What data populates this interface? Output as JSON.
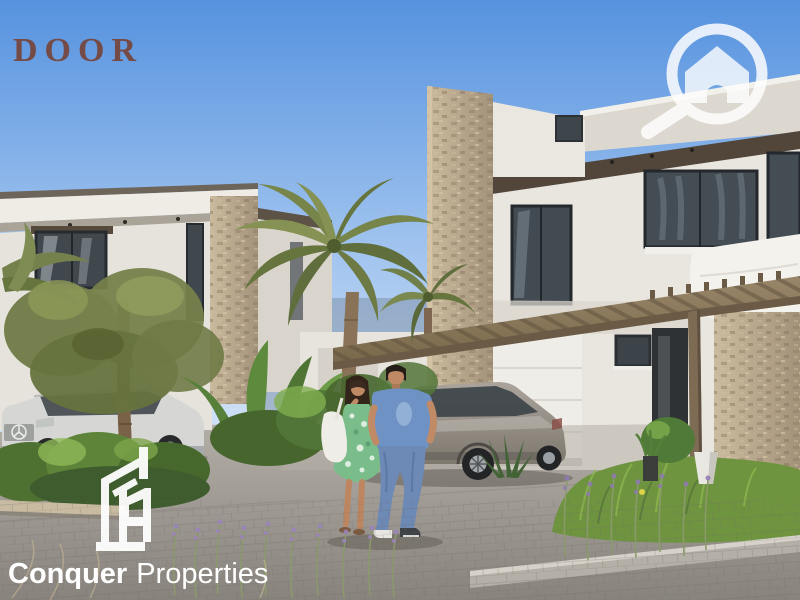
{
  "image": {
    "alt": "Render of modern two-storey villas with stone accents, palm trees, a pergola carport, parked cars and a couple walking on a paved driveway"
  },
  "watermarks": {
    "door_logo": {
      "text": "DOOR",
      "color": "#76402f"
    },
    "magnifier_house_icon": {
      "name": "magnifier-house-icon",
      "color": "#ffffff"
    },
    "conquer_logo": {
      "icon": "buildings-outline-icon",
      "name_bold": "Conquer",
      "name_light": "Properties",
      "color": "#ffffff"
    }
  },
  "palette": {
    "sky_top": "#5692df",
    "sky_horizon": "#dde9f8",
    "wall_white": "#e9e6e0",
    "stone": "#bfae94",
    "roof_fascia_dark": "#52463a",
    "pergola_wood": "#8d7a5e",
    "glass_dark": "#3e4449",
    "palm_green": "#78854a",
    "bush_green": "#5d8438",
    "driveway_gray": "#9d9890",
    "suv_silver": "#d6d7d4",
    "hatchback_gray": "#938d85",
    "dress_green": "#7abd8b",
    "shirt_blue": "#6e92c4",
    "jeans_blue": "#6d89b5"
  }
}
